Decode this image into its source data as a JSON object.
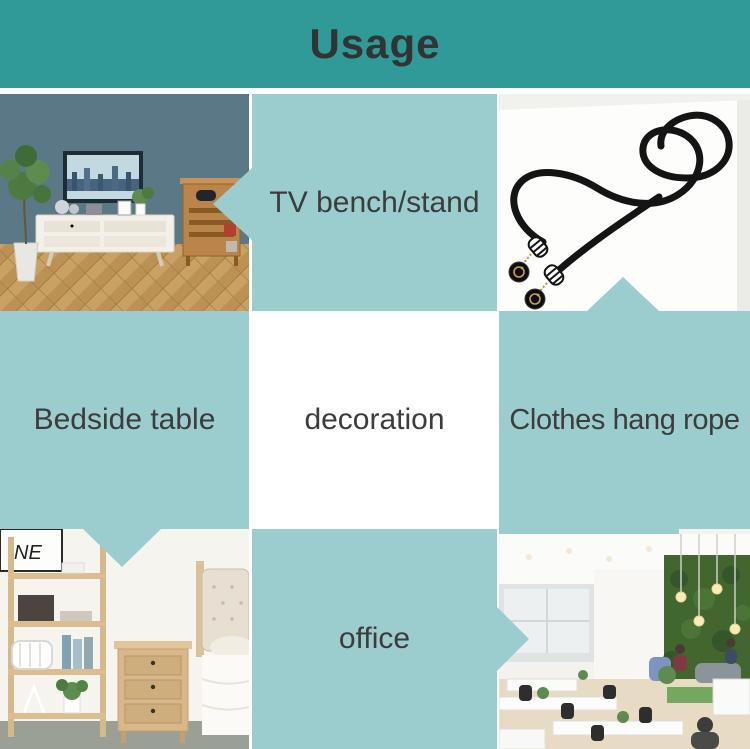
{
  "header": {
    "title": "Usage",
    "bg_color": "#2f9a97",
    "title_color": "#333333"
  },
  "palette": {
    "cell_teal": "#9bcdce",
    "label_color": "#3c3c3c",
    "background": "#ffffff"
  },
  "labels": {
    "tv": "TV bench/stand",
    "bedside": "Bedside table",
    "decoration": "decoration",
    "clothes": "Clothes hang rope",
    "office": "office"
  },
  "photos": {
    "living_room": {
      "icon": "living-room-tv-stand-photo"
    },
    "rope": {
      "icon": "black-hang-rope-product-photo"
    },
    "bedroom": {
      "icon": "bedroom-bedside-table-photo",
      "wall_art_text": "NE"
    },
    "office": {
      "icon": "open-plan-office-photo"
    }
  }
}
